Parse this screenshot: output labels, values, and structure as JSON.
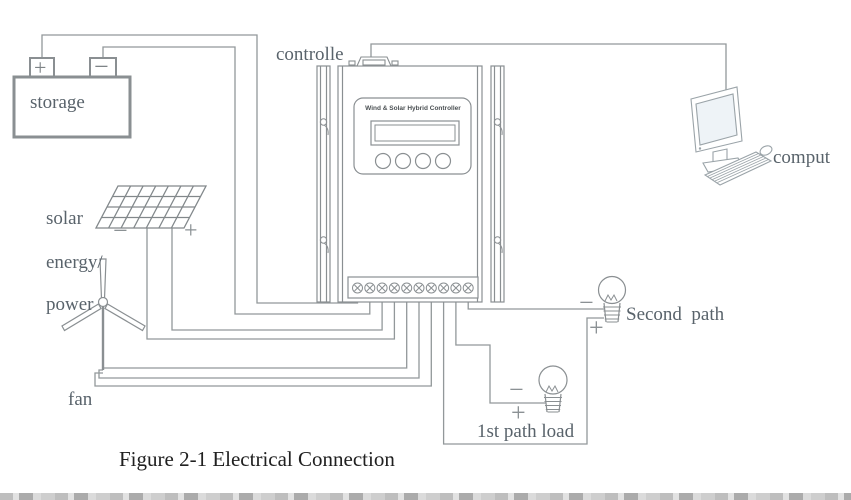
{
  "diagram": {
    "caption": "Figure 2-1 Electrical Connection",
    "labels": {
      "storage": "storage",
      "controller": "controlle",
      "computer": "comput",
      "solar1": "solar",
      "solar2": "energy/",
      "solar3": "power",
      "fan": "fan",
      "second_path": "Second  path",
      "first_path_load": "1st path load"
    },
    "controller_panel": {
      "title": "Wind & Solar Hybrid Controller",
      "button_count": 4,
      "terminal_count": 10
    },
    "signs": {
      "battery_plus": "+",
      "battery_minus": "−",
      "solar_minus": "−",
      "solar_plus": "+",
      "second_path_minus": "−",
      "second_path_plus": "+",
      "first_path_minus": "−",
      "first_path_plus": "+"
    },
    "colors": {
      "line": "#92989a",
      "label_text": "#59636b",
      "caption_text": "#202020",
      "screen_tint": "#eef3f7"
    }
  }
}
